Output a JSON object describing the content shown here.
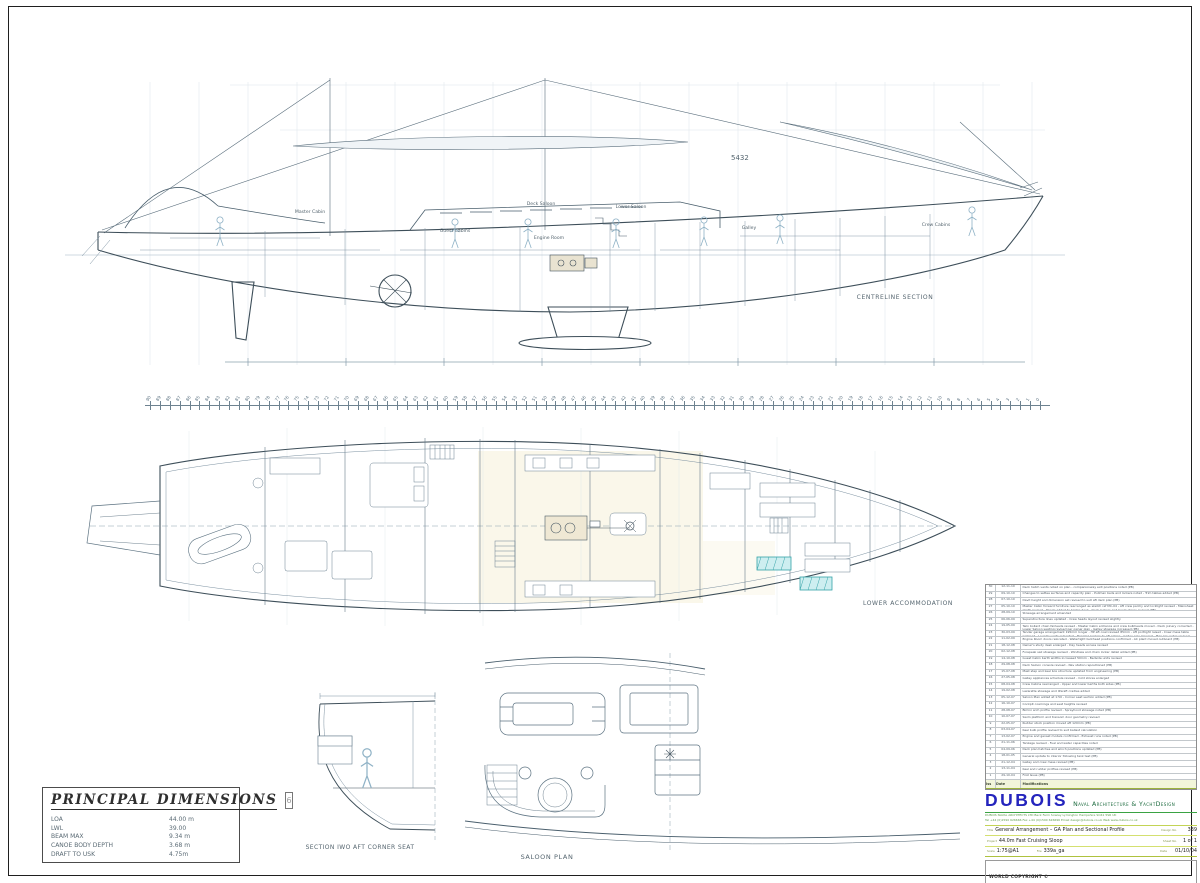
{
  "profile": {
    "view_label": "CENTRELINE SECTION",
    "sail_number": "5432",
    "room_labels": [
      "Master Cabin",
      "Guest Cabins",
      "Deck Saloon",
      "Lower Saloon",
      "Engine Room",
      "Galley",
      "Crew Cabins"
    ]
  },
  "ruler": {
    "from": 90,
    "to": 0
  },
  "plan": {
    "view_label": "LOWER ACCOMMODATION"
  },
  "section": {
    "view_label": "SECTION IWO AFT CORNER SEAT"
  },
  "saloon": {
    "view_label": "SALOON PLAN"
  },
  "dimensions": {
    "title": "PRINCIPAL DIMENSIONS",
    "ref": "6",
    "rows": [
      {
        "name": "LOA",
        "value": "44.00 m"
      },
      {
        "name": "LWL",
        "value": "39.00"
      },
      {
        "name": "BEAM MAX",
        "value": "9.34 m"
      },
      {
        "name": "CANOE BODY DEPTH",
        "value": "3.68 m"
      },
      {
        "name": "DRAFT TO USK",
        "value": "4.75m"
      }
    ]
  },
  "revisions": {
    "header": {
      "no": "Iss",
      "date": "Date",
      "text": "Modifications"
    },
    "rows": [
      {
        "no": "30",
        "date": "12-11-10",
        "text": "Deck hatch vents noted on plan - companionway exit positions noted (PB)"
      },
      {
        "no": "29",
        "date": "09-10-10",
        "text": "Changes to settee surfaces and capacity plan - Pullman beds and lockers noted - Trim tables added (PB)"
      },
      {
        "no": "28",
        "date": "07-10-10",
        "text": "Davit height and dimension set revised to suit aft deck plan (PB)"
      },
      {
        "no": "27",
        "date": "05-10-10",
        "text": "Master Cabin forward furniture rearranged as sketch ref MC-04 - Aft crew pantry and locklight revised - Mainsheet plinth revised - Panels added to bridge deck - Deck lockers and boom stores revised (PB)"
      },
      {
        "no": "26",
        "date": "28-09-10",
        "text": "Stowage arrangement amended"
      },
      {
        "no": "25",
        "date": "06-06-09",
        "text": "Superstructure lines updated - Crew heads layout revised slightly"
      },
      {
        "no": "24",
        "date": "19-05-09",
        "text": "Twin bollard chain fairleads revised - Master Cabin entrance and crew bulkheads moved - Deck joinery corrected - Lower Saloon seating revised per owner plan - Galley stowage increased (PB)"
      },
      {
        "no": "23",
        "date": "30-03-09",
        "text": "Tender garage arrangement 195mm longer - HP aft cowl revised 85mm - Aft portlight raised - Crew mess table widened - Laundry units relocated - Hanging lockers to aft cabins - Galley sole lowered - Plan key notes revised (PB)"
      },
      {
        "no": "22",
        "date": "11-02-09",
        "text": "Engine Room doors relocated - Watertight bulkhead positions confirmed - AC plant moved outboard (PB)"
      },
      {
        "no": "21",
        "date": "18-12-08",
        "text": "Owner's study desk enlarged - Day heads access revised"
      },
      {
        "no": "20",
        "date": "02-12-08",
        "text": "Forepeak sail stowage revised - Windlass and chain locker detail added (PB)"
      },
      {
        "no": "19",
        "date": "14-10-08",
        "text": "Guest Cabin berth widths increased 50mm - Bedside units revised"
      },
      {
        "no": "18",
        "date": "29-08-08",
        "text": "Deck Saloon console revised - Nav station repositioned (PB)"
      },
      {
        "no": "17",
        "date": "15-07-08",
        "text": "Mast step and keel box structure updated from engineering (PB)"
      },
      {
        "no": "16",
        "date": "27-05-08",
        "text": "Galley appliances schedule revised - Cold stores enlarged"
      },
      {
        "no": "15",
        "date": "08-04-08",
        "text": "Crew Cabins rearranged - Upper and lower berths both sides (PB)"
      },
      {
        "no": "14",
        "date": "19-02-08",
        "text": "Lazarette stowage and liferaft cradles added"
      },
      {
        "no": "13",
        "date": "05-12-07",
        "text": "Saloon Plan added at 1:50 - Corner seat section added (PB)"
      },
      {
        "no": "12",
        "date": "16-10-07",
        "text": "Cockpit coamings and seat heights revised"
      },
      {
        "no": "11",
        "date": "28-08-07",
        "text": "Bimini arch profile revised - Sprayhood stowage noted (PB)"
      },
      {
        "no": "10",
        "date": "10-07-07",
        "text": "Swim platform and transom door geometry revised"
      },
      {
        "no": "9",
        "date": "22-05-07",
        "text": "Rudder stock position moved aft 120mm (PB)"
      },
      {
        "no": "8",
        "date": "03-04-07",
        "text": "Keel bulb profile revised to suit ballast calculation"
      },
      {
        "no": "7",
        "date": "13-02-07",
        "text": "Engine and genset models confirmed - Exhaust runs noted (PB)"
      },
      {
        "no": "6",
        "date": "21-11-06",
        "text": "Tankage revised - Fuel and water capacities noted"
      },
      {
        "no": "5",
        "date": "04-09-06",
        "text": "Deck plan hatches and winch positions updated (PB)"
      },
      {
        "no": "4",
        "date": "18-01-05",
        "text": "General update to interior following tank test (PB)"
      },
      {
        "no": "3",
        "date": "21-12-04",
        "text": "Galley and crew mess revised (PB)"
      },
      {
        "no": "2",
        "date": "13-11-04",
        "text": "Keel and rudder profiles revised (PB)"
      },
      {
        "no": "1",
        "date": "29-10-04",
        "text": "First Issue (PB)"
      }
    ]
  },
  "titleblock": {
    "logo": "DUBOIS",
    "logo_suffix": "Naval Architecture & YachtDesign",
    "address_line1": "DUBOIS NAVAL ARCHITECTS LTD   Beck Farm   Sowley   Lymington   Hampshire   SO41 5SR   UK",
    "address_line2": "Tel +44 (0)1590 626666   Fax +44 (0)1590 626696   Email design@dubois.co.uk   Web www.dubois.co.uk",
    "fields": {
      "title_label": "Title",
      "title": "General Arrangement – GA Plan and Sectional Profile",
      "design_no_label": "Design No.",
      "design_no": "339",
      "project_label": "Project",
      "project": "44.0m Fast Cruising Sloop",
      "sheet_label": "Sheet No.",
      "sheet": "1 of 1",
      "scale_label": "Scale",
      "scale": "1:75@A1",
      "file_label": "File",
      "file": "339a_ga",
      "date_label": "Date",
      "date": "01/10/04"
    },
    "copyright_title": "WORLD COPYRIGHT ©",
    "copyright_text": "Copying, reproduction or disclosure in whole or in part of this design, whether by graphic, visual, electronic or any other means, is forbidden without the express written permission of Dubois Naval Architects Ltd. UK"
  }
}
